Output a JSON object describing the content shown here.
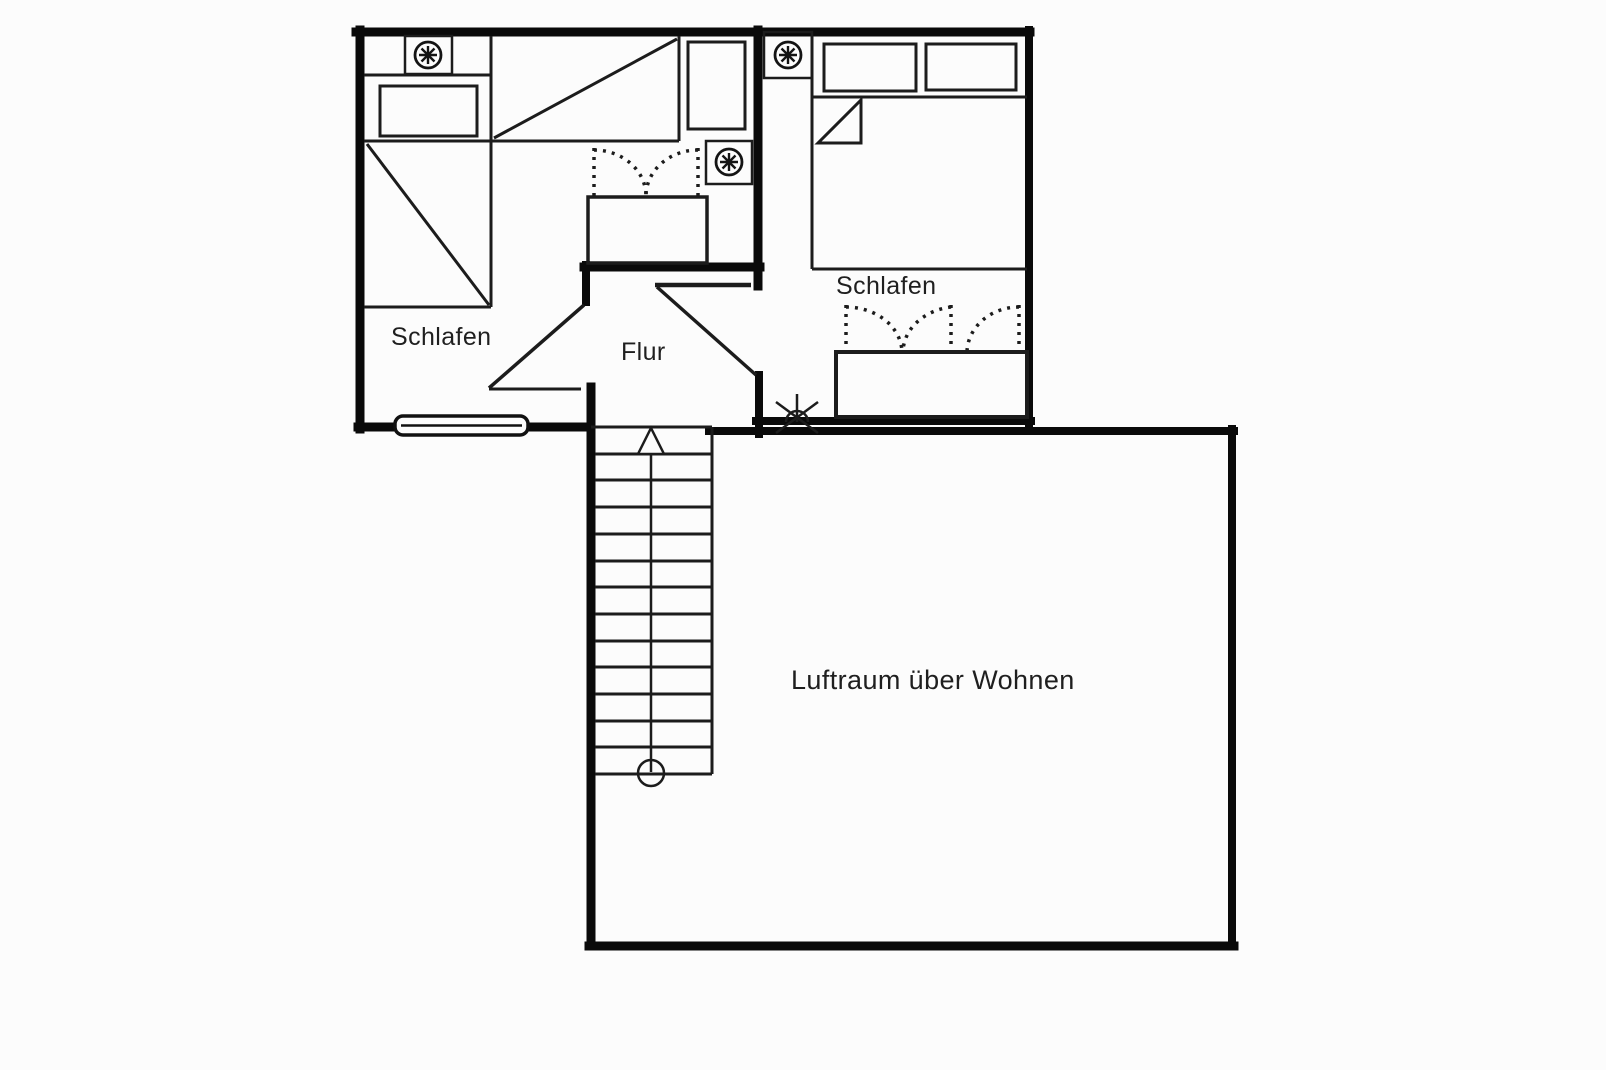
{
  "canvas": {
    "background": "#fcfcfc",
    "thin_line_color": "#1c1c1c",
    "wall_color": "#0a0a0a",
    "text_color": "#1f1f1f"
  },
  "labels": {
    "bedroom_left": "Schlafen",
    "bedroom_right": "Schlafen",
    "hallway": "Flur",
    "void_above_living": "Luftraum über Wohnen"
  },
  "rooms": [
    {
      "name": "bedroom-left",
      "label": "Schlafen"
    },
    {
      "name": "bedroom-right",
      "label": "Schlafen"
    },
    {
      "name": "hallway",
      "label": "Flur"
    },
    {
      "name": "void-above-living-room",
      "label": "Luftraum über Wohnen"
    }
  ],
  "fixtures": {
    "ceiling_lamp_count": 3,
    "bed_count": 3,
    "pillow_count": 3,
    "wardrobe_count": 2,
    "window_count": 1,
    "roof_window_symbol_count": 1,
    "door_count": 2,
    "stairs": {
      "treads": 13,
      "direction_marker": "arrow-up",
      "start_marker": "circle"
    }
  }
}
